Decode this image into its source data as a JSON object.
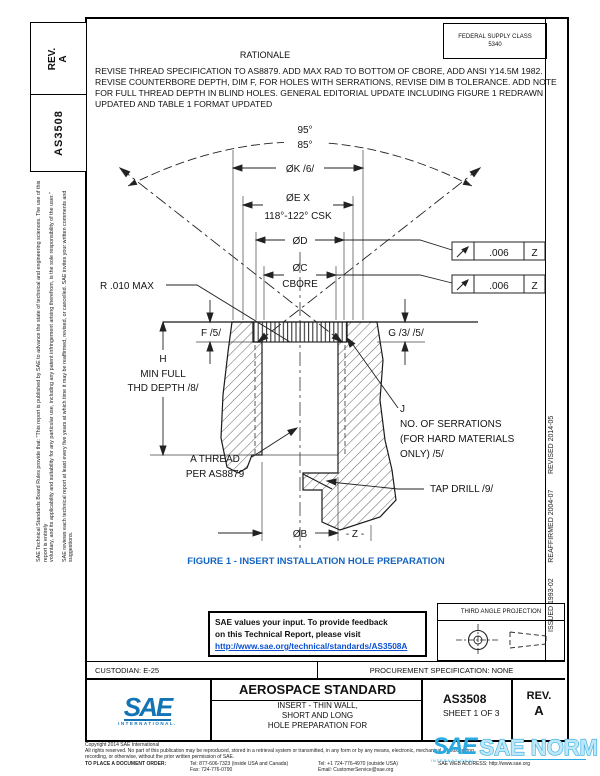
{
  "sidebar": {
    "rev_label": "REV.",
    "rev_value": "A",
    "doc_number": "AS3508",
    "disclaimer_line1": "SAE Technical Standards Board Rules provide that: \"This report is published by SAE to advance the state of technical and engineering sciences. The use of this report is entirely",
    "disclaimer_line2": "voluntary, and its applicability and suitability for any particular use, including any patent infringement arising therefrom, is the sole responsibility of the user.\"",
    "disclaimer_line3": "SAE reviews each technical report at least every five years at which time it may be reaffirmed, revised, or cancelled. SAE invites your written comments and suggestions.",
    "right_edge_text": "ISSUED 1993-02        REAFFIRMED 2004-07        REVISED 2014-05"
  },
  "header": {
    "federal_supply_class_line1": "FEDERAL SUPPLY CLASS",
    "federal_supply_class_line2": "5340",
    "rationale_title": "RATIONALE",
    "rationale_lines": [
      "REVISE THREAD SPECIFICATION TO AS8879. ADD MAX RAD TO BOTTOM OF CBORE, ADD ANSI Y14.5M 1982.",
      "REVISE COUNTERBORE DEPTH, DIM F, FOR HOLES WITH SERRATIONS, REVISE DIM B TOLERANCE. ADD NOTE",
      "FOR FULL THREAD DEPTH IN BLIND HOLES. GENERAL EDITORIAL UPDATE INCLUDING FIGURE 1 REDRAWN",
      "UPDATED AND TABLE 1 FORMAT UPDATED"
    ]
  },
  "figure": {
    "caption": "FIGURE 1 - INSERT INSTALLATION HOLE PREPARATION",
    "labels": {
      "angle_upper": "95°",
      "angle_lower": "85°",
      "dia_k": "ØK /6/",
      "dia_e1": "ØE X",
      "dia_e2": "118°-122° CSK",
      "dia_d": "ØD",
      "dia_c1": "ØC",
      "dia_c2": "CBORE",
      "radius_max": "R .010 MAX",
      "f_dim": "F /5/",
      "g_dim": "G /3/ /5/",
      "h1": "H",
      "h2": "MIN FULL",
      "h3": "THD DEPTH /8/",
      "thread1": "A THREAD",
      "thread2": "PER AS8879",
      "serr1": "J",
      "serr2": "NO. OF SERRATIONS",
      "serr3": "(FOR HARD MATERIALS",
      "serr4": "ONLY) /5/",
      "tap_drill": "TAP DRILL /9/",
      "dia_b": "ØB",
      "datum_z": "- Z -"
    },
    "fcf": {
      "value": ".006",
      "datum": "Z"
    }
  },
  "feedback_box": {
    "line1": "SAE values your input. To provide feedback",
    "line2": "on this Technical Report, please visit",
    "link": "http://www.sae.org/technical/standards/AS3508A"
  },
  "projection": {
    "label": "THIRD ANGLE PROJECTION"
  },
  "info_row": {
    "custodian": "CUSTODIAN: E-25",
    "procurement": "PROCUREMENT SPECIFICATION: NONE"
  },
  "title_block": {
    "logo_text": "SAE",
    "logo_subtext": "INTERNATIONAL.",
    "standard_type": "AEROSPACE STANDARD",
    "title_line1": "INSERT - THIN WALL,",
    "title_line2": "SHORT AND LONG",
    "title_line3": "HOLE PREPARATION FOR",
    "doc_number": "AS3508",
    "sheet": "SHEET 1 OF 3",
    "rev_label": "REV.",
    "rev_value": "A"
  },
  "footer": {
    "copyright": "Copyright 2014 SAE International",
    "rights_line1": "All rights reserved. No part of this publication may be reproduced, stored in a retrieval system or transmitted, in any form or by any means, electronic, mechanical, photocopying,",
    "rights_line2": "recording, or otherwise, without the prior written permission of SAE.",
    "order_label": "TO PLACE A DOCUMENT ORDER:",
    "tel_inside": "Tel: 877-606-7323 (inside USA and Canada)",
    "fax": "Fax: 724-776-0790",
    "tel_outside": "Tel: +1 724-776-4970 (outside USA)",
    "email": "Email: CustomerService@sae.org",
    "web": "SAE WEB ADDRESS: http://www.sae.org"
  },
  "watermark": {
    "logo": "SAE",
    "logo_sub": "INTERNATIONAL.",
    "text": "SAE NORM"
  },
  "colors": {
    "caption_blue": "#1565c0",
    "link_blue": "#0a4fd6",
    "sae_blue": "#1273b5",
    "watermark_blue": "#29abe2"
  }
}
